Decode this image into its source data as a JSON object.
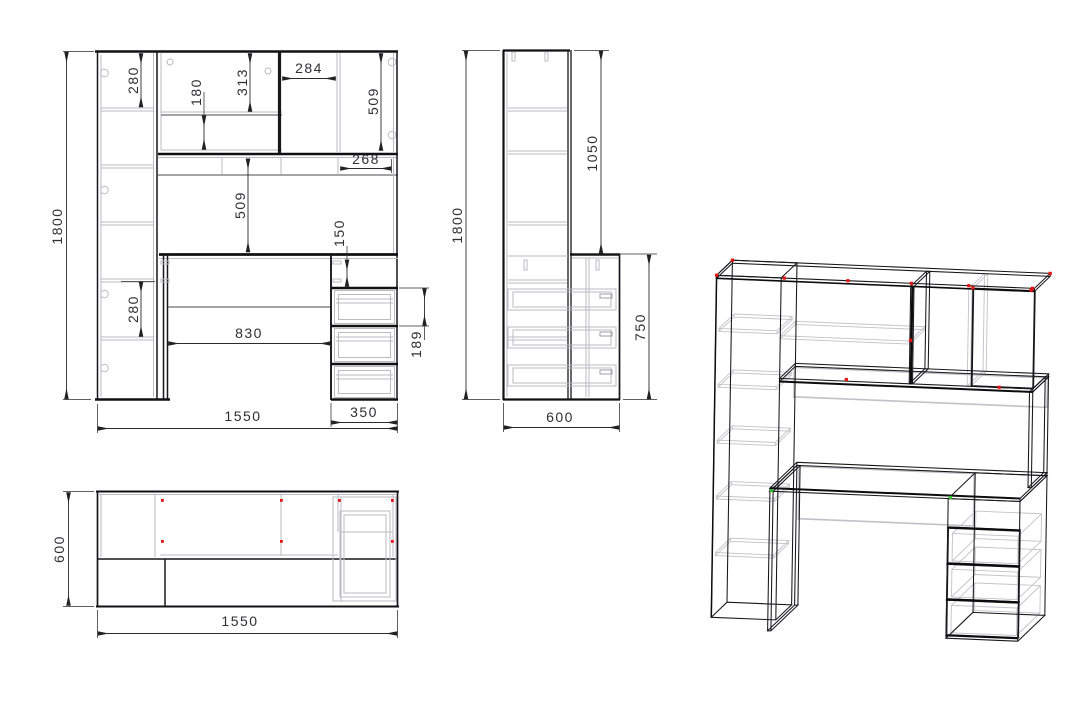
{
  "front_view": {
    "label": "front view",
    "dims": {
      "total_height": "1800",
      "total_width": "1550",
      "drawer_unit_width": "350",
      "top_shelf": "280",
      "lower_shelf": "280",
      "upper_box": "313",
      "upper_gap": "180",
      "niche_width": "284",
      "right_niche_height": "509",
      "right_niche_width": "268",
      "middle_niche_height": "509",
      "keyboard_gap": "150",
      "desk_opening": "830",
      "drawer_pitch": "189"
    }
  },
  "side_view": {
    "label": "side view",
    "dims": {
      "total_height": "1800",
      "hutch_height": "1050",
      "desk_height": "750",
      "depth": "600"
    }
  },
  "top_view": {
    "label": "top view",
    "dims": {
      "depth": "600",
      "total_width": "1550"
    }
  },
  "iso_view": {
    "label": "isometric view"
  },
  "colors": {
    "edge": "#17171a",
    "hidden": "#bcbcc3",
    "dimension": "#2f2f33",
    "marker_red": "#ea1010",
    "marker_green": "#2fbf2f",
    "background": "#ffffff"
  }
}
